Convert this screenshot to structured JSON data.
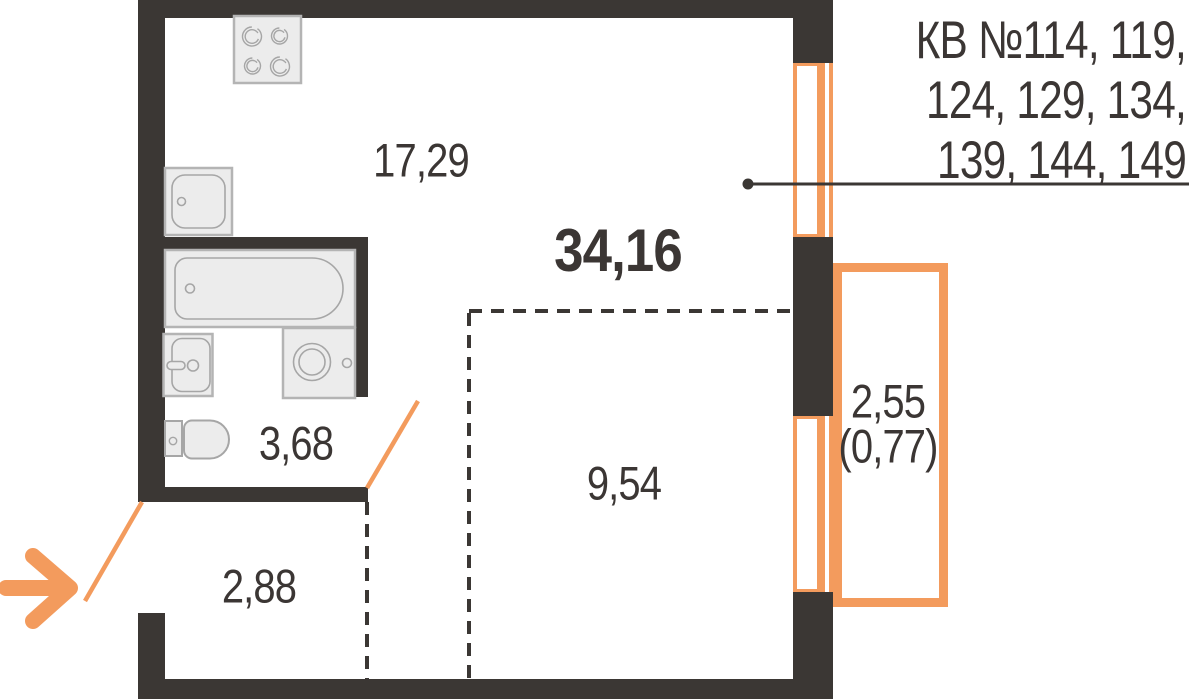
{
  "plan": {
    "apartment_numbers": {
      "line1": "КВ №114, 119,",
      "line2": "124, 129, 134,",
      "line3": "139, 144, 149"
    },
    "areas": {
      "total": "34,16",
      "kitchen_living": "17,29",
      "room": "9,54",
      "bathroom": "3,68",
      "hallway": "2,88",
      "balcony": "2,55",
      "balcony_coefficient": "(0,77)"
    },
    "colors": {
      "wall": "#3b3734",
      "accent_orange": "#f39b5d",
      "text": "#3b3634",
      "fixture_fill": "#ececec",
      "fixture_border": "#b4b4b4",
      "fixture_stroke": "#a6a6a6"
    },
    "icons": [
      "stove-icon",
      "kitchen-sink-icon",
      "bathtub-icon",
      "washing-machine-icon",
      "washbasin-icon",
      "toilet-icon",
      "entrance-arrow-icon",
      "window-icon",
      "leader-line"
    ]
  }
}
